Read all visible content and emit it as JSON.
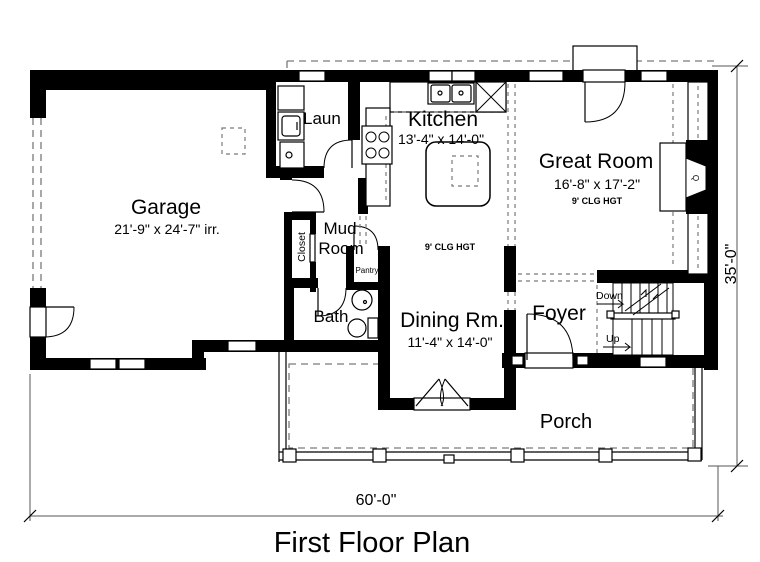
{
  "title": "First Floor Plan",
  "dimensions": {
    "overall_width": "60'-0\"",
    "overall_height": "35'-0\""
  },
  "rooms": {
    "garage": {
      "name": "Garage",
      "size": "21'-9\" x 24'-7\" irr."
    },
    "laundry": {
      "name": "Laun"
    },
    "kitchen": {
      "name": "Kitchen",
      "size": "13'-4\" x 14'-0\"",
      "ceiling": "9' CLG HGT"
    },
    "great_room": {
      "name": "Great Room",
      "size": "16'-8\" x 17'-2\"",
      "ceiling": "9' CLG HGT"
    },
    "mud_room": {
      "line1": "Mud",
      "line2": "Room"
    },
    "closet": {
      "name": "Closet"
    },
    "pantry": {
      "name": "Pantry"
    },
    "bath": {
      "name": "Bath"
    },
    "dining": {
      "name": "Dining Rm.",
      "size": "11'-4\" x 14'-0\""
    },
    "foyer": {
      "name": "Foyer"
    },
    "porch": {
      "name": "Porch"
    }
  },
  "stairs": {
    "down_label": "Down",
    "up_label": "Up"
  },
  "fireplace": {
    "label": "Q"
  },
  "colors": {
    "walls": "#000000",
    "background": "#ffffff",
    "dashed_lines": "#7a7a7a"
  }
}
